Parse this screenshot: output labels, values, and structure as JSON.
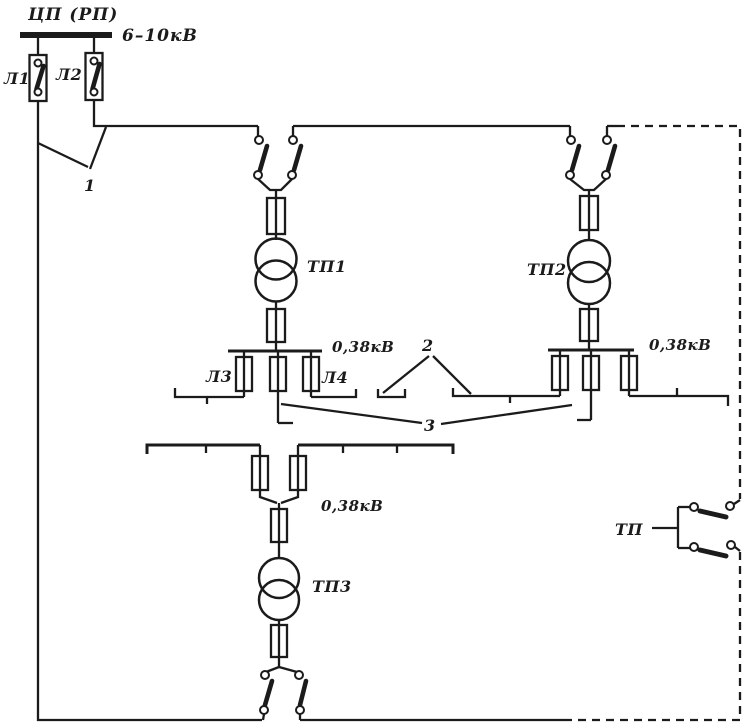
{
  "colors": {
    "ink": "#1b1b1b",
    "paper": "#ffffff"
  },
  "source": {
    "title": "ЦП (РП)",
    "busbar_voltage": "6–10кВ"
  },
  "feeders": {
    "l1": "Л1",
    "l2": "Л2",
    "l3": "Л3",
    "l4": "Л4"
  },
  "substations": {
    "tp1": "ТП1",
    "tp2": "ТП2",
    "tp3": "ТП3"
  },
  "lv_voltage": {
    "tp1": "0,38кВ",
    "tp2": "0,38кВ",
    "tp3": "0,38кВ"
  },
  "callouts": {
    "one": "1",
    "two": "2",
    "three": "3"
  },
  "legend": {
    "tp": "ТП"
  }
}
